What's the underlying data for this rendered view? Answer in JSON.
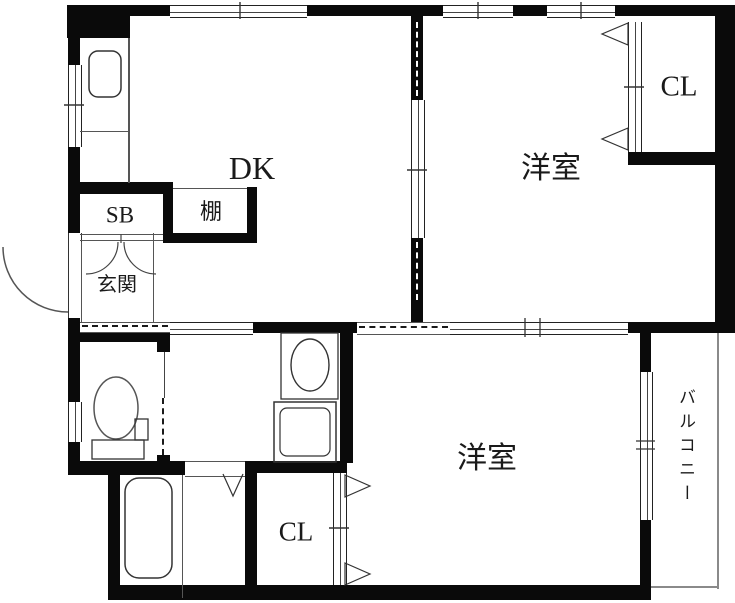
{
  "floorplan": {
    "type": "japanese-apartment-floorplan",
    "labels": {
      "dk": "DK",
      "western_room_top": "洋室",
      "western_room_bottom": "洋室",
      "closet_top": "CL",
      "closet_bottom": "CL",
      "shoe_box": "SB",
      "shelf": "棚",
      "entrance": "玄関",
      "balcony": "バルコニー"
    },
    "fixtures": [
      "kitchen-sink",
      "toilet",
      "washbasin",
      "washing-machine-pan",
      "bathtub",
      "entrance-door-swing",
      "shoebox-double-doors",
      "bifold-closet-doors",
      "bathroom-door"
    ],
    "colors": {
      "wall": "#0a0a0a",
      "background": "#ffffff",
      "thin_line": "#555555",
      "text": "#1a1a1a"
    }
  }
}
